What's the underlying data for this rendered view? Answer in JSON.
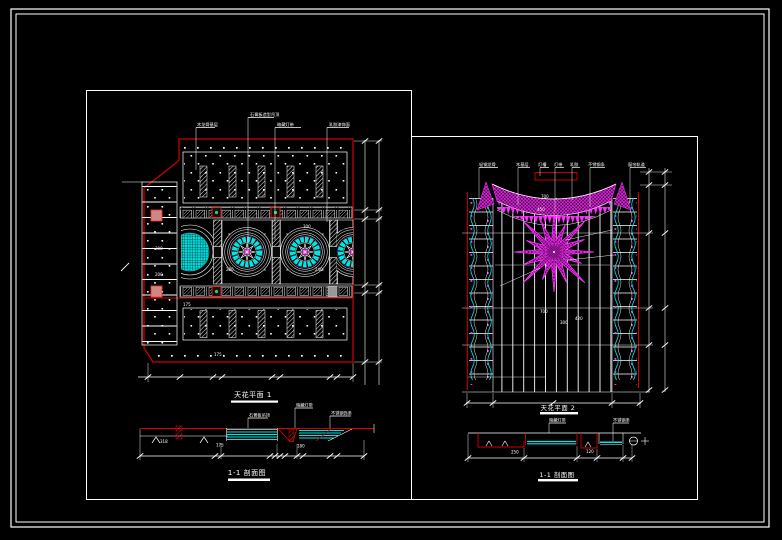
{
  "colors": {
    "background": "#000000",
    "frame": "#ffffff",
    "red": "#d40000",
    "magenta": "#ff30ff",
    "cyan": "#00e5e5",
    "pink_square": "#cf8783",
    "accent_green": "#33cc55",
    "accent_gray": "#999999"
  },
  "left_drawing": {
    "plan_title": "天花平面 1",
    "section_title": "1-1 剖面图",
    "leader_labels": [
      "木龙骨基层",
      "石膏板造型吊顶",
      "暗藏灯带",
      "乳胶漆饰面"
    ],
    "section_labels": [
      "石膏板吊顶",
      "暗藏灯带",
      "不锈钢饰条"
    ],
    "dims": {
      "cells_a": "300",
      "cells_b": "200",
      "band_top": "175",
      "band_bottom": "175",
      "medallion_a": "300",
      "medallion_b": "240",
      "medallion_c": "200",
      "sec_a": "318",
      "sec_b": "175",
      "sec_c": "180"
    }
  },
  "right_drawing": {
    "plan_title": "天花平面 2",
    "section_title": "1-1 剖面图",
    "leader_labels": [
      "轻钢龙骨",
      "木基层",
      "灯槽",
      "灯带",
      "乳胶",
      "不锈钢条",
      "窗帘轨道"
    ],
    "section_labels": [
      "暗藏灯带",
      "不锈钢条"
    ],
    "dims": {
      "swag_a": "700",
      "swag_b": "450",
      "floor_a": "700",
      "floor_b": "300",
      "floor_c": "420",
      "sec_a": "250",
      "sec_b": "120"
    }
  }
}
